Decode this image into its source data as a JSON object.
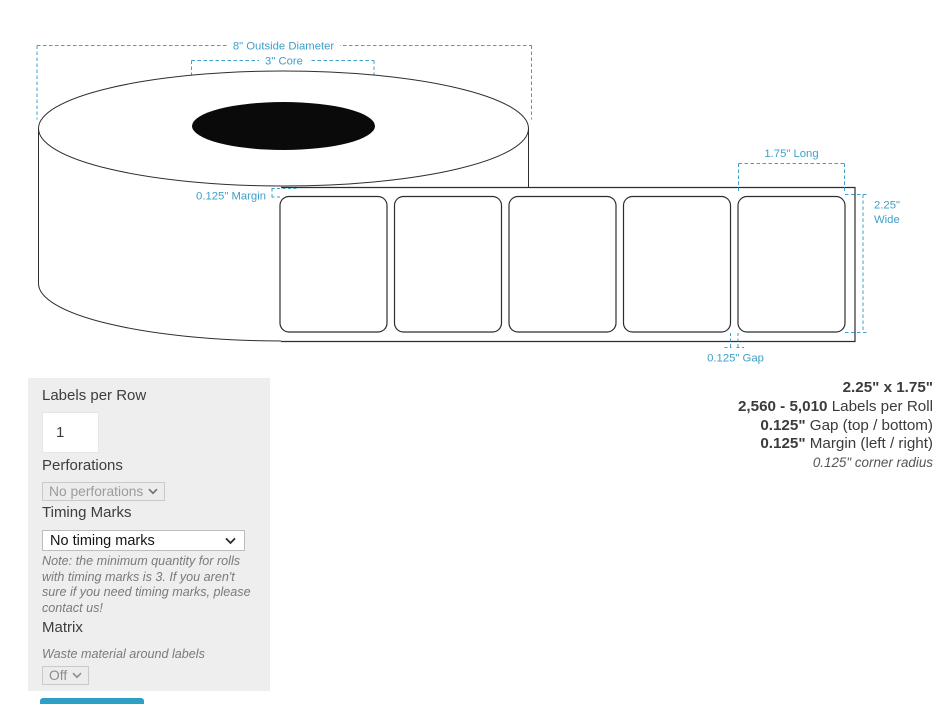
{
  "diagram": {
    "annotations": {
      "outside_diameter": "8\" Outside Diameter",
      "core": "3\" Core",
      "margin": "0.125\" Margin",
      "long": "1.75\" Long",
      "wide_line1": "2.25\"",
      "wide_line2": "Wide",
      "gap": "0.125\" Gap"
    },
    "colors": {
      "annotation_accent": "#3E9FC7",
      "outline": "#2e2e2e",
      "core_fill": "#0a0a0a"
    }
  },
  "summary": {
    "size": "2.25\" x 1.75\"",
    "labels_per_roll_value": "2,560 - 5,010",
    "labels_per_roll_label": " Labels per Roll",
    "gap_value": "0.125\"",
    "gap_label": " Gap (top / bottom)",
    "margin_value": "0.125\"",
    "margin_label": " Margin (left / right)",
    "corner_radius": "0.125\" corner radius"
  },
  "panel": {
    "labels_per_row_label": "Labels per Row",
    "labels_per_row_value": "1",
    "perforations_label": "Perforations",
    "perforations_value": "No perforations",
    "timing_marks_label": "Timing Marks",
    "timing_marks_value": "No timing marks",
    "timing_note": "Note: the minimum quantity for rolls with timing marks is 3. If you aren't sure if you need timing marks, please contact us!",
    "matrix_label": "Matrix",
    "matrix_sublabel": "Waste material around labels",
    "matrix_value": "Off"
  }
}
